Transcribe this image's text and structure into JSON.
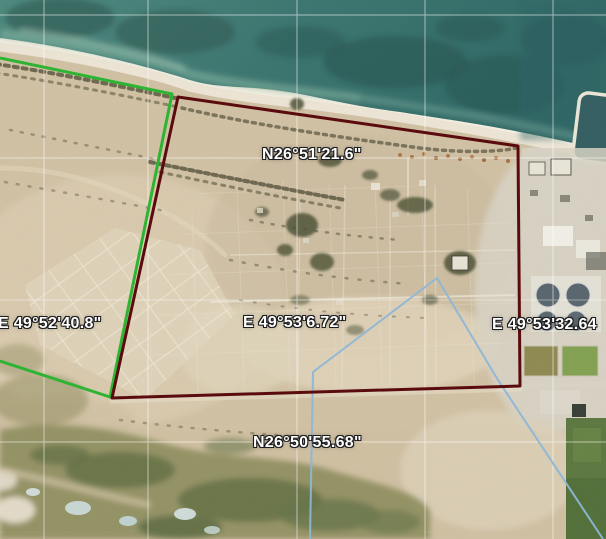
{
  "map": {
    "view": "satellite",
    "labels": {
      "lat_top": "N26°51'21.6\"",
      "lat_bottom": "N26°50'55.68\"",
      "lon_left": "E 49°52'40.8\"",
      "lon_mid": "E 49°53'6.72\"",
      "lon_right": "E 49°53'32.64"
    },
    "colors": {
      "boundary_green": "#2eb433",
      "boundary_red": "#5a0b0e",
      "route_blue": "#8db6d6",
      "graticule": "#ffffff"
    }
  }
}
